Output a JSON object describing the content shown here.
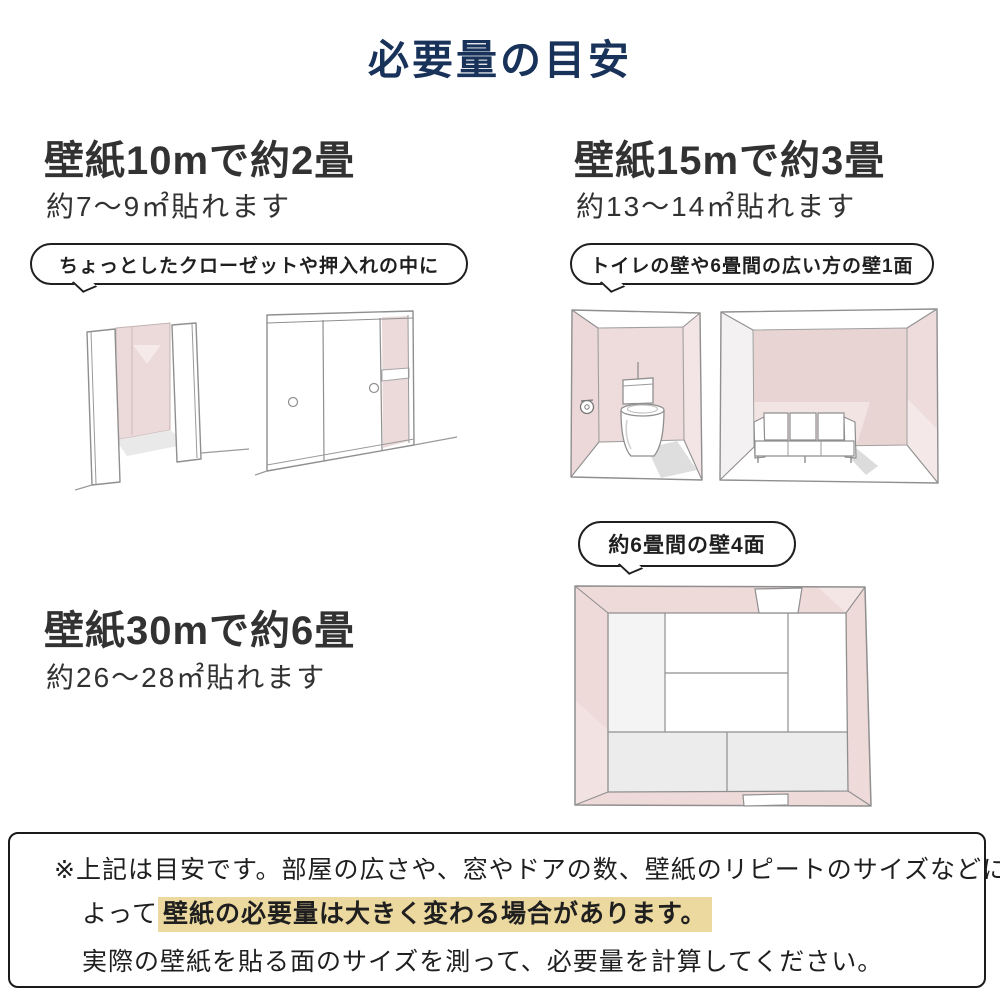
{
  "title": "必要量の目安",
  "sections": {
    "s10": {
      "heading": "壁紙10mで約2畳",
      "sub": "約7〜9㎡貼れます",
      "bubble": "ちょっとしたクローゼットや押入れの中に"
    },
    "s15": {
      "heading": "壁紙15mで約3畳",
      "sub": "約13〜14㎡貼れます",
      "bubble": "トイレの壁や6畳間の広い方の壁1面"
    },
    "s30": {
      "heading": "壁紙30mで約6畳",
      "sub": "約26〜28㎡貼れます",
      "bubble": "約6畳間の壁4面"
    }
  },
  "note": {
    "line1": "※上記は目安です。部屋の広さや、窓やドアの数、壁紙のリピートのサイズなどに",
    "line2_prefix": "よって",
    "line2_highlight": "壁紙の必要量は大きく変わる場合があります。",
    "line3": "実際の壁紙を貼る面のサイズを測って、必要量を計算してください。"
  },
  "illustrations": {
    "closet_open": "small-closet-with-open-doors",
    "closet_sliding": "oshiire-sliding-door-closet",
    "toilet_room": "toilet-room-with-pink-walls",
    "sofa_room": "six-tatami-room-wide-wall-with-sofa",
    "room_topdown": "six-tatami-room-top-view-four-walls"
  },
  "colors": {
    "title_navy": "#18325a",
    "text_dark": "#323232",
    "wall_pink": "#eedada",
    "wall_pink_light": "#f3e5e5",
    "highlight_yellow": "#ecd9a0",
    "sketch_stroke": "#8f8f8f"
  }
}
